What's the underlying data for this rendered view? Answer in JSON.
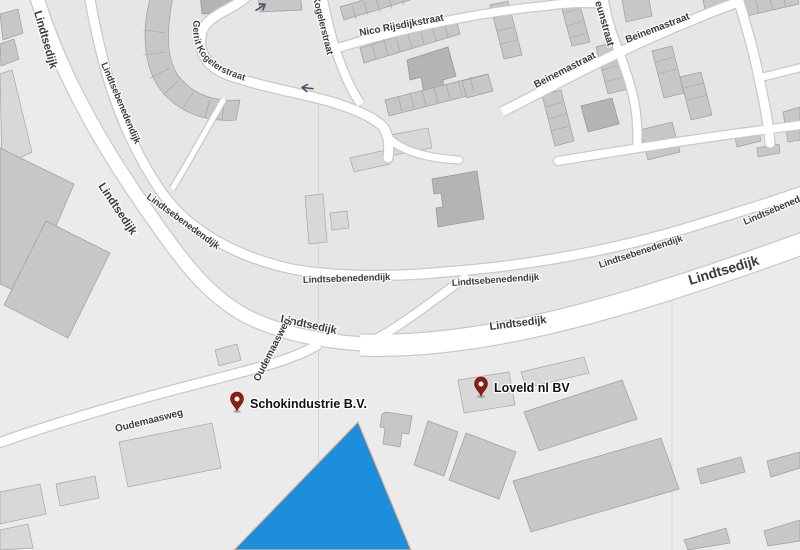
{
  "map": {
    "style": "grayscale-roadmap",
    "colors": {
      "land_dark": "#e6e6e6",
      "land_light": "#ecebeb",
      "road": "#ffffff",
      "road_casing": "#c9c9c9",
      "building": "#c7c7c9",
      "water": "#1d8edb",
      "shoreline": "#edb488",
      "pin": "#8e1d12",
      "label_text": "#3c3c3c"
    },
    "street_labels": [
      {
        "text": "Lindtsedijk"
      },
      {
        "text": "Lindtsedijk"
      },
      {
        "text": "Lindtsedijk"
      },
      {
        "text": "Lindtsedijk"
      },
      {
        "text": "Lindtsedijk"
      },
      {
        "text": "Lindtsebenedendijk"
      },
      {
        "text": "Lindtsebenedendijk"
      },
      {
        "text": "Lindtsebenedendijk"
      },
      {
        "text": "Lindtsebenedendijk"
      },
      {
        "text": "Lindtsebenedendijk"
      },
      {
        "text": "Lindtsebenedendijk"
      },
      {
        "text": "Gerrit Kogelerstraat"
      },
      {
        "text": "Gerrit Kogelerstraat"
      },
      {
        "text": "Nico Rijsdijkstraat"
      },
      {
        "text": "Beinemastraat"
      },
      {
        "text": "Beinemastraat"
      },
      {
        "text": "eunstraat"
      },
      {
        "text": "Oudemaasweg"
      },
      {
        "text": "Oudemaasweg"
      }
    ],
    "markers": [
      {
        "label": "Schokindustrie B.V.",
        "pin_color": "#8e1d12"
      },
      {
        "label": "Loveld nl BV",
        "pin_color": "#8e1d12"
      }
    ],
    "icons": [
      {
        "name": "one-way-arrow",
        "count": 2
      }
    ],
    "water_feature": {
      "shape": "triangle",
      "position": "bottom-center"
    }
  }
}
